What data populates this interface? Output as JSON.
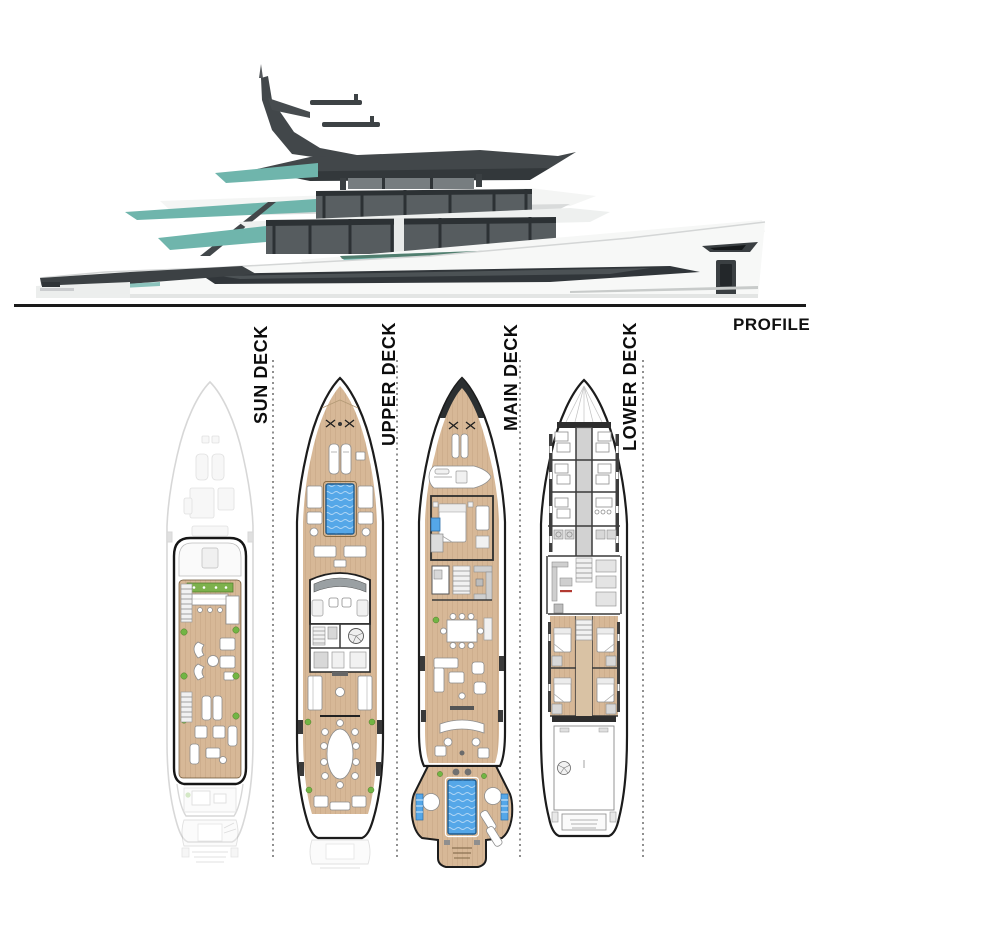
{
  "title": "Yacht general arrangement plan",
  "profile": {
    "label": "PROFILE"
  },
  "decks": [
    {
      "id": "sun-deck",
      "label": "SUN DECK"
    },
    {
      "id": "upper-deck",
      "label": "UPPER DECK"
    },
    {
      "id": "main-deck",
      "label": "MAIN DECK"
    },
    {
      "id": "lower-deck",
      "label": "LOWER DECK"
    }
  ],
  "colors": {
    "deck-tan": "#d7b897",
    "deck-tan-line": "#b08c5f",
    "pool-blue": "#55a7e8",
    "teal-glass": "#6fb5ac",
    "superstructure-dark": "#42474a",
    "window-dark": "#31363a",
    "plant-green": "#72b544",
    "wall-dark": "#2e2e2e",
    "ghost-gray": "#bdbdbd",
    "ruler": "#8f8f8f"
  }
}
